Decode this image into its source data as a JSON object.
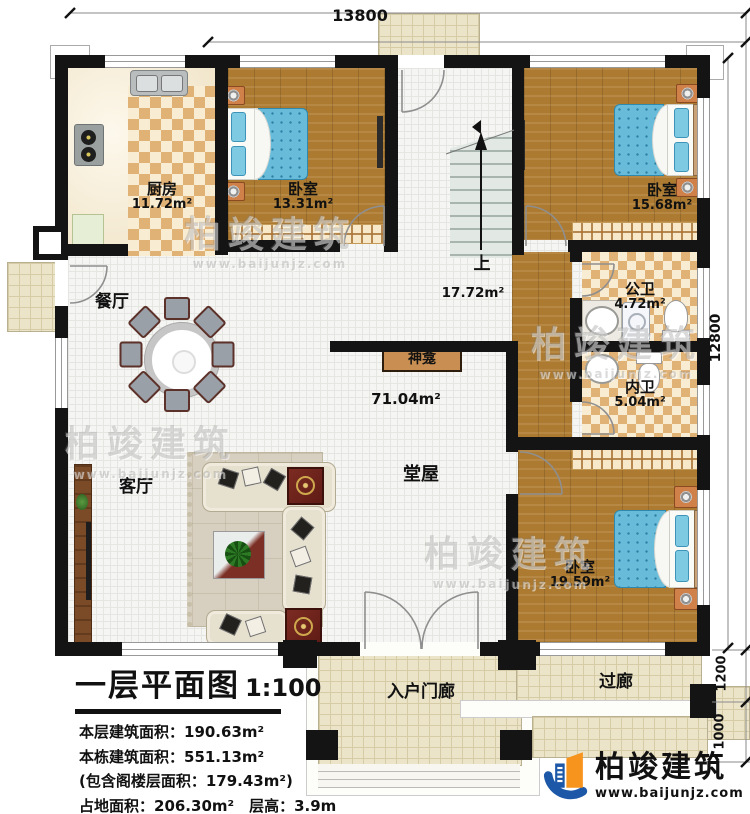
{
  "colors": {
    "wall": "#141414",
    "wood": "#ac7a31",
    "bed_blue": "#68bcd9",
    "checker_dark": "#e1b276",
    "checker_light": "#f8ecd3",
    "logo_blue": "#1c57a8",
    "logo_orange": "#f7941d"
  },
  "dimensions": {
    "width_top": "13800",
    "height_right": "12800",
    "porch_depth": "1200",
    "step_depth": "1000"
  },
  "rooms": {
    "kitchen": {
      "name": "厨房",
      "area": "11.72m²"
    },
    "bedroom1": {
      "name": "卧室",
      "area": "13.31m²"
    },
    "bedroom2": {
      "name": "卧室",
      "area": "15.68m²"
    },
    "bedroom3": {
      "name": "卧室",
      "area": "19.59m²"
    },
    "stair": {
      "name": "上",
      "area": "17.72m²"
    },
    "public_bath": {
      "name": "公卫",
      "area": "4.72m²"
    },
    "private_bath": {
      "name": "内卫",
      "area": "5.04m²"
    },
    "main_hall": {
      "name": "堂屋",
      "area": "71.04m²"
    },
    "shrine": {
      "name": "神龛"
    },
    "dining": {
      "name": "餐厅"
    },
    "living": {
      "name": "客厅"
    },
    "entry_porch": {
      "name": "入户门廊"
    },
    "corridor": {
      "name": "过廊"
    }
  },
  "title_block": {
    "title": "一层平面图",
    "scale": "1:100",
    "stats": [
      "本层建筑面积：190.63m²",
      "本栋建筑面积：551.13m²",
      "(包含阁楼层面积：179.43m²)",
      "占地面积：206.30m²　层高：3.9m"
    ]
  },
  "brand": {
    "name": "柏竣建筑",
    "url": "www.baijunjz.com"
  },
  "watermark": {
    "text": "柏竣建筑",
    "url": "www.baijunjz.com"
  }
}
